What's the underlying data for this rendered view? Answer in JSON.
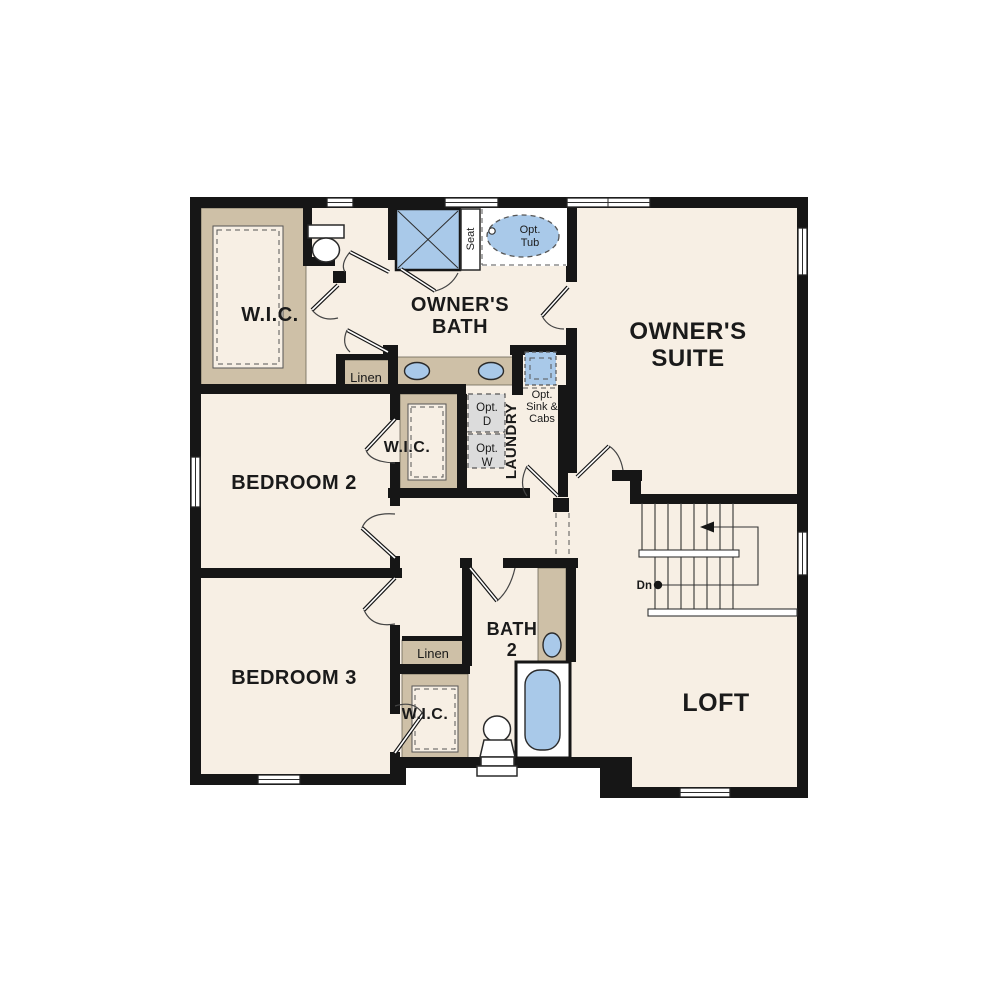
{
  "colors": {
    "background": "#ffffff",
    "floor": "#f7efe4",
    "wall": "#161616",
    "cabinet": "#cec0a7",
    "fixture_blue": "#a9c9e9",
    "appliance_gray": "#dcdcdc",
    "line": "#2e2e2e",
    "dash": "#555555"
  },
  "rooms": {
    "wic1": "W.I.C.",
    "owners_bath_line1": "OWNER'S",
    "owners_bath_line2": "BATH",
    "owners_suite_line1": "OWNER'S",
    "owners_suite_line2": "SUITE",
    "bedroom2": "BEDROOM 2",
    "bedroom3": "BEDROOM 3",
    "loft": "LOFT",
    "wic2": "W.I.C.",
    "wic3": "W.I.C.",
    "bath2_line1": "BATH",
    "bath2_line2": "2",
    "laundry": "LAUNDRY"
  },
  "labels": {
    "linen1": "Linen",
    "linen2": "Linen",
    "seat": "Seat",
    "opt_tub_line1": "Opt.",
    "opt_tub_line2": "Tub",
    "opt_dryer_line1": "Opt.",
    "opt_dryer_line2": "D",
    "opt_washer_line1": "Opt.",
    "opt_washer_line2": "W",
    "opt_sink_line1": "Opt.",
    "opt_sink_line2": "Sink &",
    "opt_sink_line3": "Cabs",
    "stair_direction": "Dn"
  }
}
